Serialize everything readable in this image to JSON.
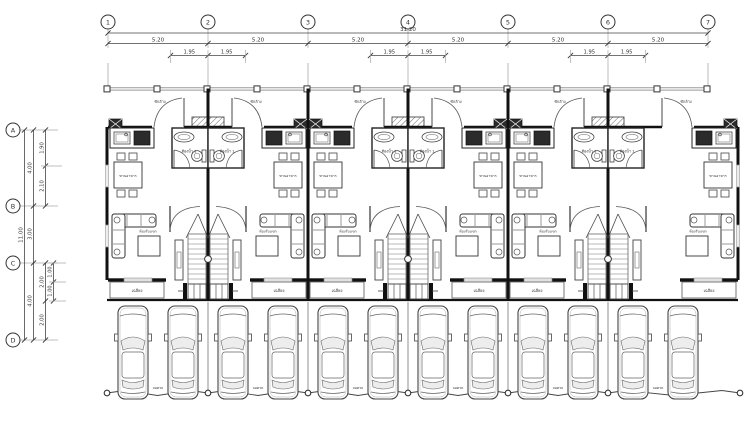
{
  "sheet": {
    "type": "architectural-floor-plan",
    "units_count": 6,
    "cars_per_unit": 2
  },
  "grid": {
    "col_bubbles": [
      "1",
      "2",
      "3",
      "4",
      "5",
      "6",
      "7"
    ],
    "row_bubbles": [
      "A",
      "B",
      "C",
      "D"
    ]
  },
  "top_dims": {
    "overall": "31.20",
    "bays": [
      "5.20",
      "5.20",
      "5.20",
      "5.20",
      "5.20",
      "5.20"
    ],
    "half_bays": [
      "1.95",
      "1.95",
      "1.95",
      "1.95",
      "1.95",
      "1.95"
    ]
  },
  "left_dims": {
    "overall": "11.00",
    "segments": [
      "4.00",
      "3.00",
      "4.00"
    ],
    "ab_split": [
      "1.90",
      "2.10"
    ],
    "cd_split": [
      "2.00",
      "2.00"
    ],
    "cd_inner_split": [
      "1.00",
      "1.00"
    ]
  },
  "rooms": {
    "bathroom": "ห้องน้ำ 1",
    "dining": "ทานอาหาร",
    "living": "ห้องรับแขก",
    "porch": "เฉลียง",
    "laundry": "ซักล้าง",
    "parking": "จอดรถ"
  },
  "colors": {
    "wall": "#111111",
    "line": "#444444",
    "light_line": "#888888",
    "fence": "#999999",
    "glass": "#ededed",
    "paper": "#ffffff"
  }
}
